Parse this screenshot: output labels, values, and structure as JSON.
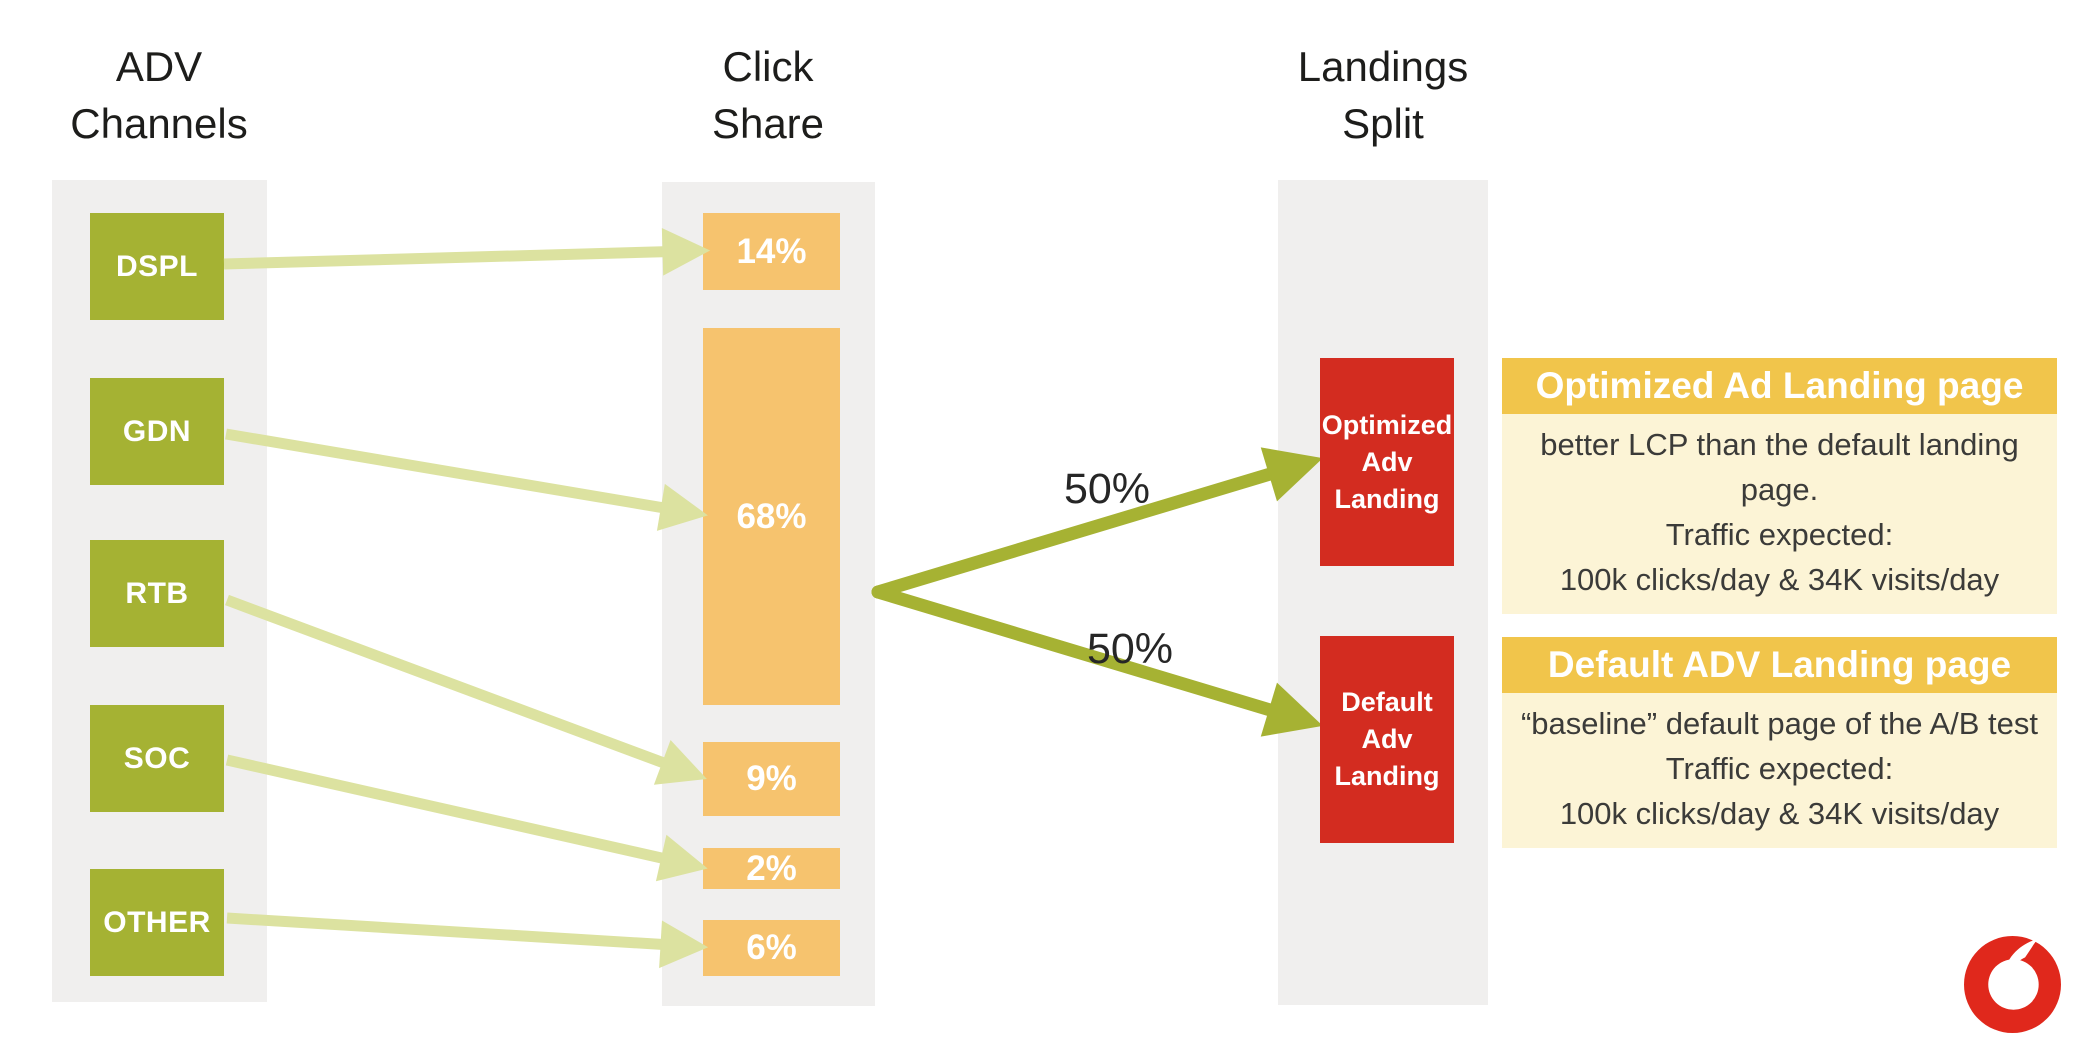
{
  "headers": {
    "channels": "ADV Channels",
    "click_share": "Click Share",
    "landings_split": "Landings Split"
  },
  "channels": {
    "items": [
      {
        "label": "DSPL"
      },
      {
        "label": "GDN"
      },
      {
        "label": "RTB"
      },
      {
        "label": "SOC"
      },
      {
        "label": "OTHER"
      }
    ]
  },
  "click_share": {
    "items": [
      {
        "label": "14%",
        "value": 14
      },
      {
        "label": "68%",
        "value": 68
      },
      {
        "label": "9%",
        "value": 9
      },
      {
        "label": "2%",
        "value": 2
      },
      {
        "label": "6%",
        "value": 6
      }
    ]
  },
  "split": {
    "upper_label": "50%",
    "lower_label": "50%"
  },
  "landings": {
    "items": [
      {
        "lines": [
          "Optimized",
          "Adv",
          "Landing"
        ]
      },
      {
        "lines": [
          "Default",
          "Adv",
          "Landing"
        ]
      }
    ]
  },
  "panels": {
    "items": [
      {
        "title": "Optimized Ad Landing page",
        "lines": [
          "better LCP than the default landing page.",
          "Traffic expected:",
          "100k clicks/day  & 34K visits/day"
        ]
      },
      {
        "title": "Default ADV Landing page",
        "lines": [
          "“baseline” default page of the A/B test",
          "Traffic expected:",
          "100k clicks/day  & 34K visits/day"
        ]
      }
    ]
  },
  "icons": {
    "logo": "vodafone-speechmark"
  },
  "colors": {
    "band": "#f0efee",
    "channel_box": "#a5b233",
    "share_box": "#f6c36e",
    "landing_box": "#d32c20",
    "panel_header": "#f1c54b",
    "panel_body": "#fcf4d6",
    "arrow_light": "#dce2a0",
    "arrow_dark": "#a6b233",
    "logo_red": "#e0281c",
    "text_dark": "#1d1d1b",
    "text_body": "#3b3b39"
  }
}
